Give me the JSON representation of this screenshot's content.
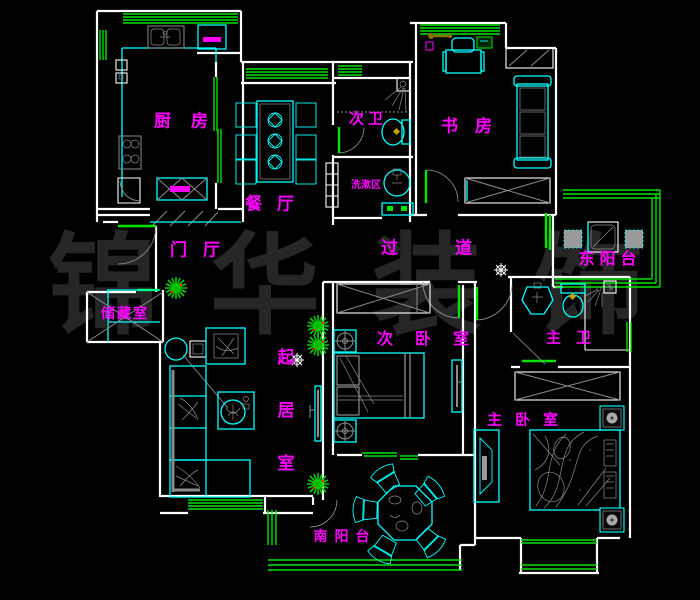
{
  "watermark": {
    "text": "锦华装饰"
  },
  "rooms": {
    "kitchen": "厨房",
    "dining": "餐厅",
    "bath2": "次卫",
    "wash_area": "洗漱区",
    "study": "书房",
    "foyer": "门厅",
    "corridor": "过道",
    "balcony_east": "东阳台",
    "storage": "储藏室",
    "living": "起居室",
    "bedroom2": "次卧室",
    "bath_master": "主卫",
    "bedroom_master": "主卧室",
    "balcony_south": "南阳台"
  },
  "colors": {
    "wall": "#ffffff",
    "window": "#00e400",
    "furniture": "#00ffff",
    "label": "#ff00ff",
    "watermark": "#262626",
    "plant": "#00cc00",
    "accent": "#ff00ff",
    "detail": "#8c8c8c",
    "gold": "#c8a000"
  }
}
